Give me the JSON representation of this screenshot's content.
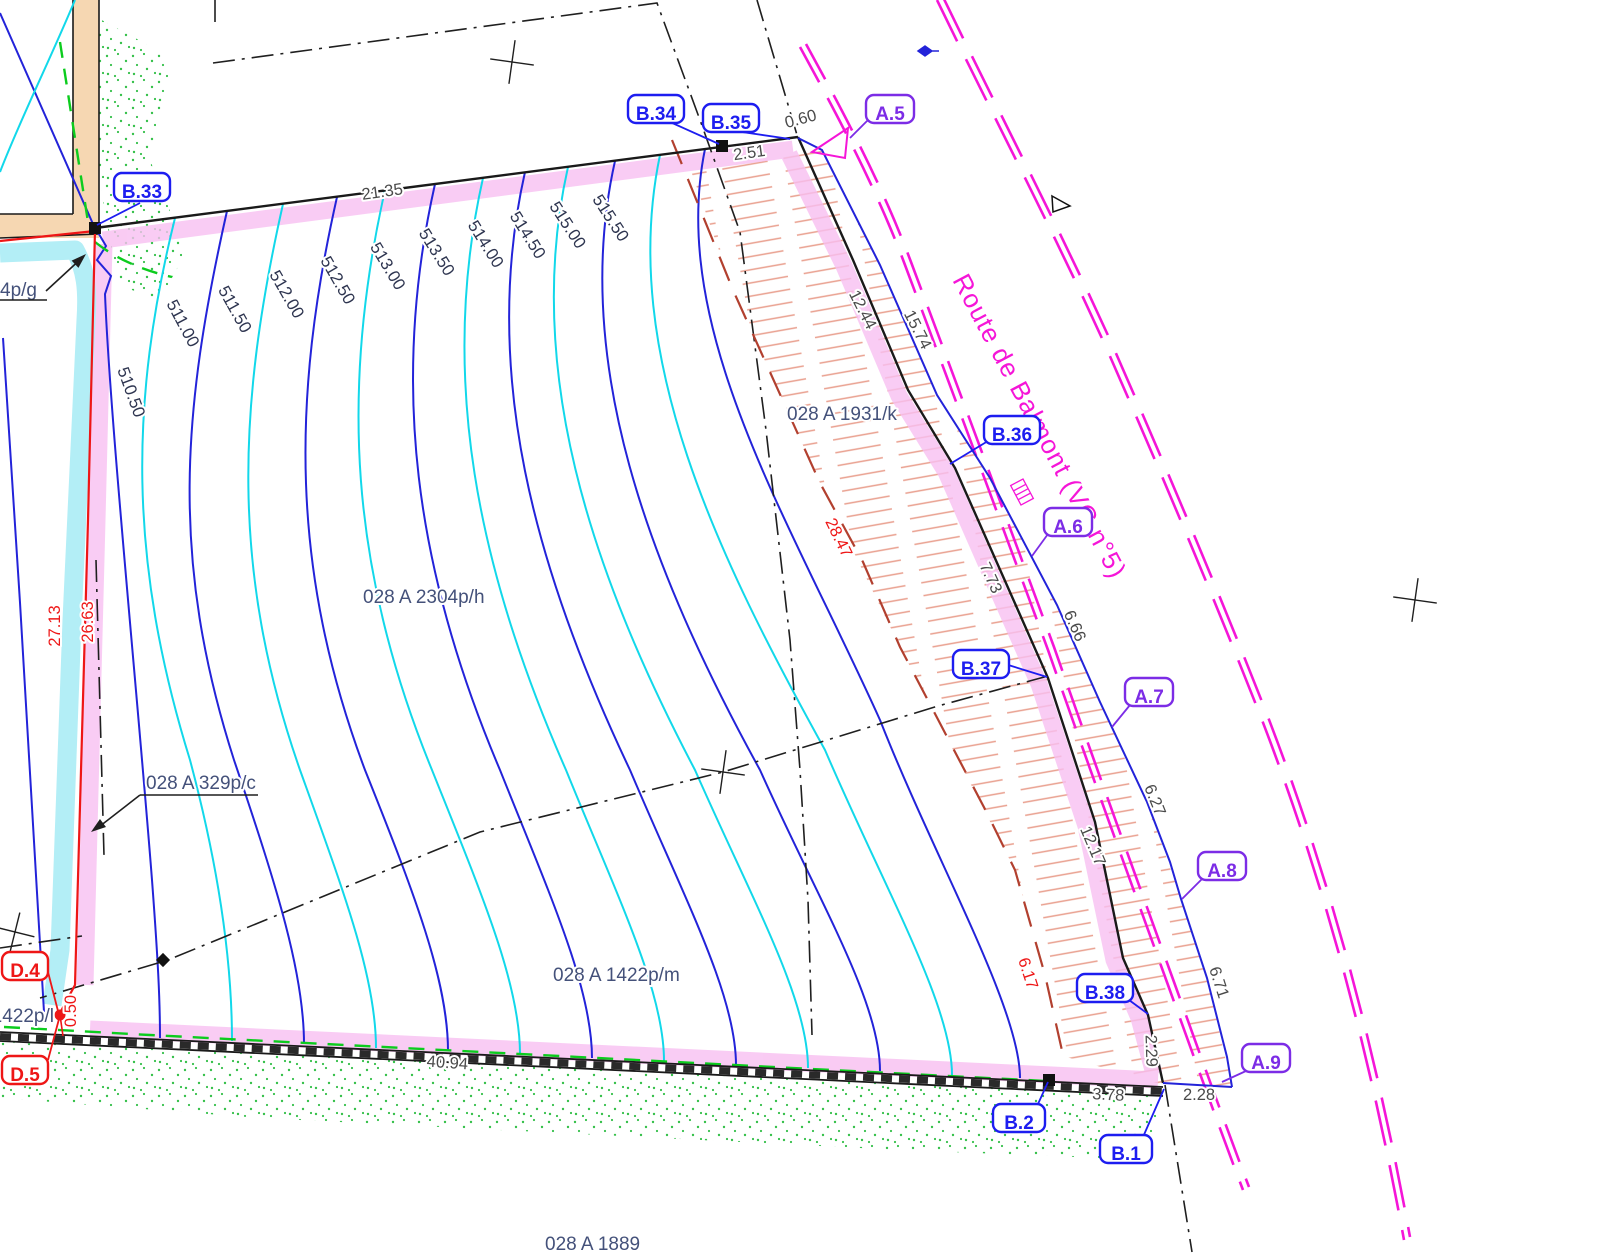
{
  "road": {
    "name": "Route de Balmont (VC n°5)"
  },
  "survey_points": {
    "b33": "B.33",
    "b34": "B.34",
    "b35": "B.35",
    "b36": "B.36",
    "b37": "B.37",
    "b38": "B.38",
    "b2": "B.2",
    "b1": "B.1",
    "a5": "A.5",
    "a6": "A.6",
    "a7": "A.7",
    "a8": "A.8",
    "a9": "A.9",
    "d4": "D.4",
    "d5": "D.5"
  },
  "parcels": {
    "p2304": "028 A 2304p/h",
    "p1931": "028 A 1931/k",
    "p329": "028 A 329p/c",
    "p1422m": "028 A 1422p/m",
    "p1422l": "1422p/l",
    "p1889": "028 A 1889",
    "p4pg": "4p/g"
  },
  "measurements": {
    "m2135": "21.35",
    "m251": "2.51",
    "m060": "0.60",
    "m1244": "12.44",
    "m1574": "15.74",
    "m773": "7.73",
    "m666": "6.66",
    "m627": "6.27",
    "m1217": "12.17",
    "m671": "6.71",
    "m229": "2.29",
    "m378": "3.78",
    "m228": "2.28",
    "m4094": "40.94",
    "m2713": "27.13",
    "m2663": "26.63",
    "m050": "0.50",
    "m2847": "28.47",
    "m617": "6.17"
  },
  "contour_labels": {
    "c5105": "510.50",
    "c511": "511.00",
    "c5115": "511.50",
    "c512": "512.00",
    "c5125": "512.50",
    "c513": "513.00",
    "c5135": "513.50",
    "c514": "514.00",
    "c5145": "514.50",
    "c515": "515.00",
    "c5155": "515.50"
  },
  "colors": {
    "contour_major": "#2323d9",
    "contour_minor": "#12d8ea",
    "road_magenta": "#f515d8",
    "boundary_pink": "#f8bff1",
    "utility_cyan": "#b3eef6",
    "building_tan": "#f6d7b2",
    "red_line": "#ee1616",
    "dashed_red_brown": "#b2402f",
    "point_label_blue": "#1d1df0",
    "point_label_purple": "#7c2ce6"
  }
}
